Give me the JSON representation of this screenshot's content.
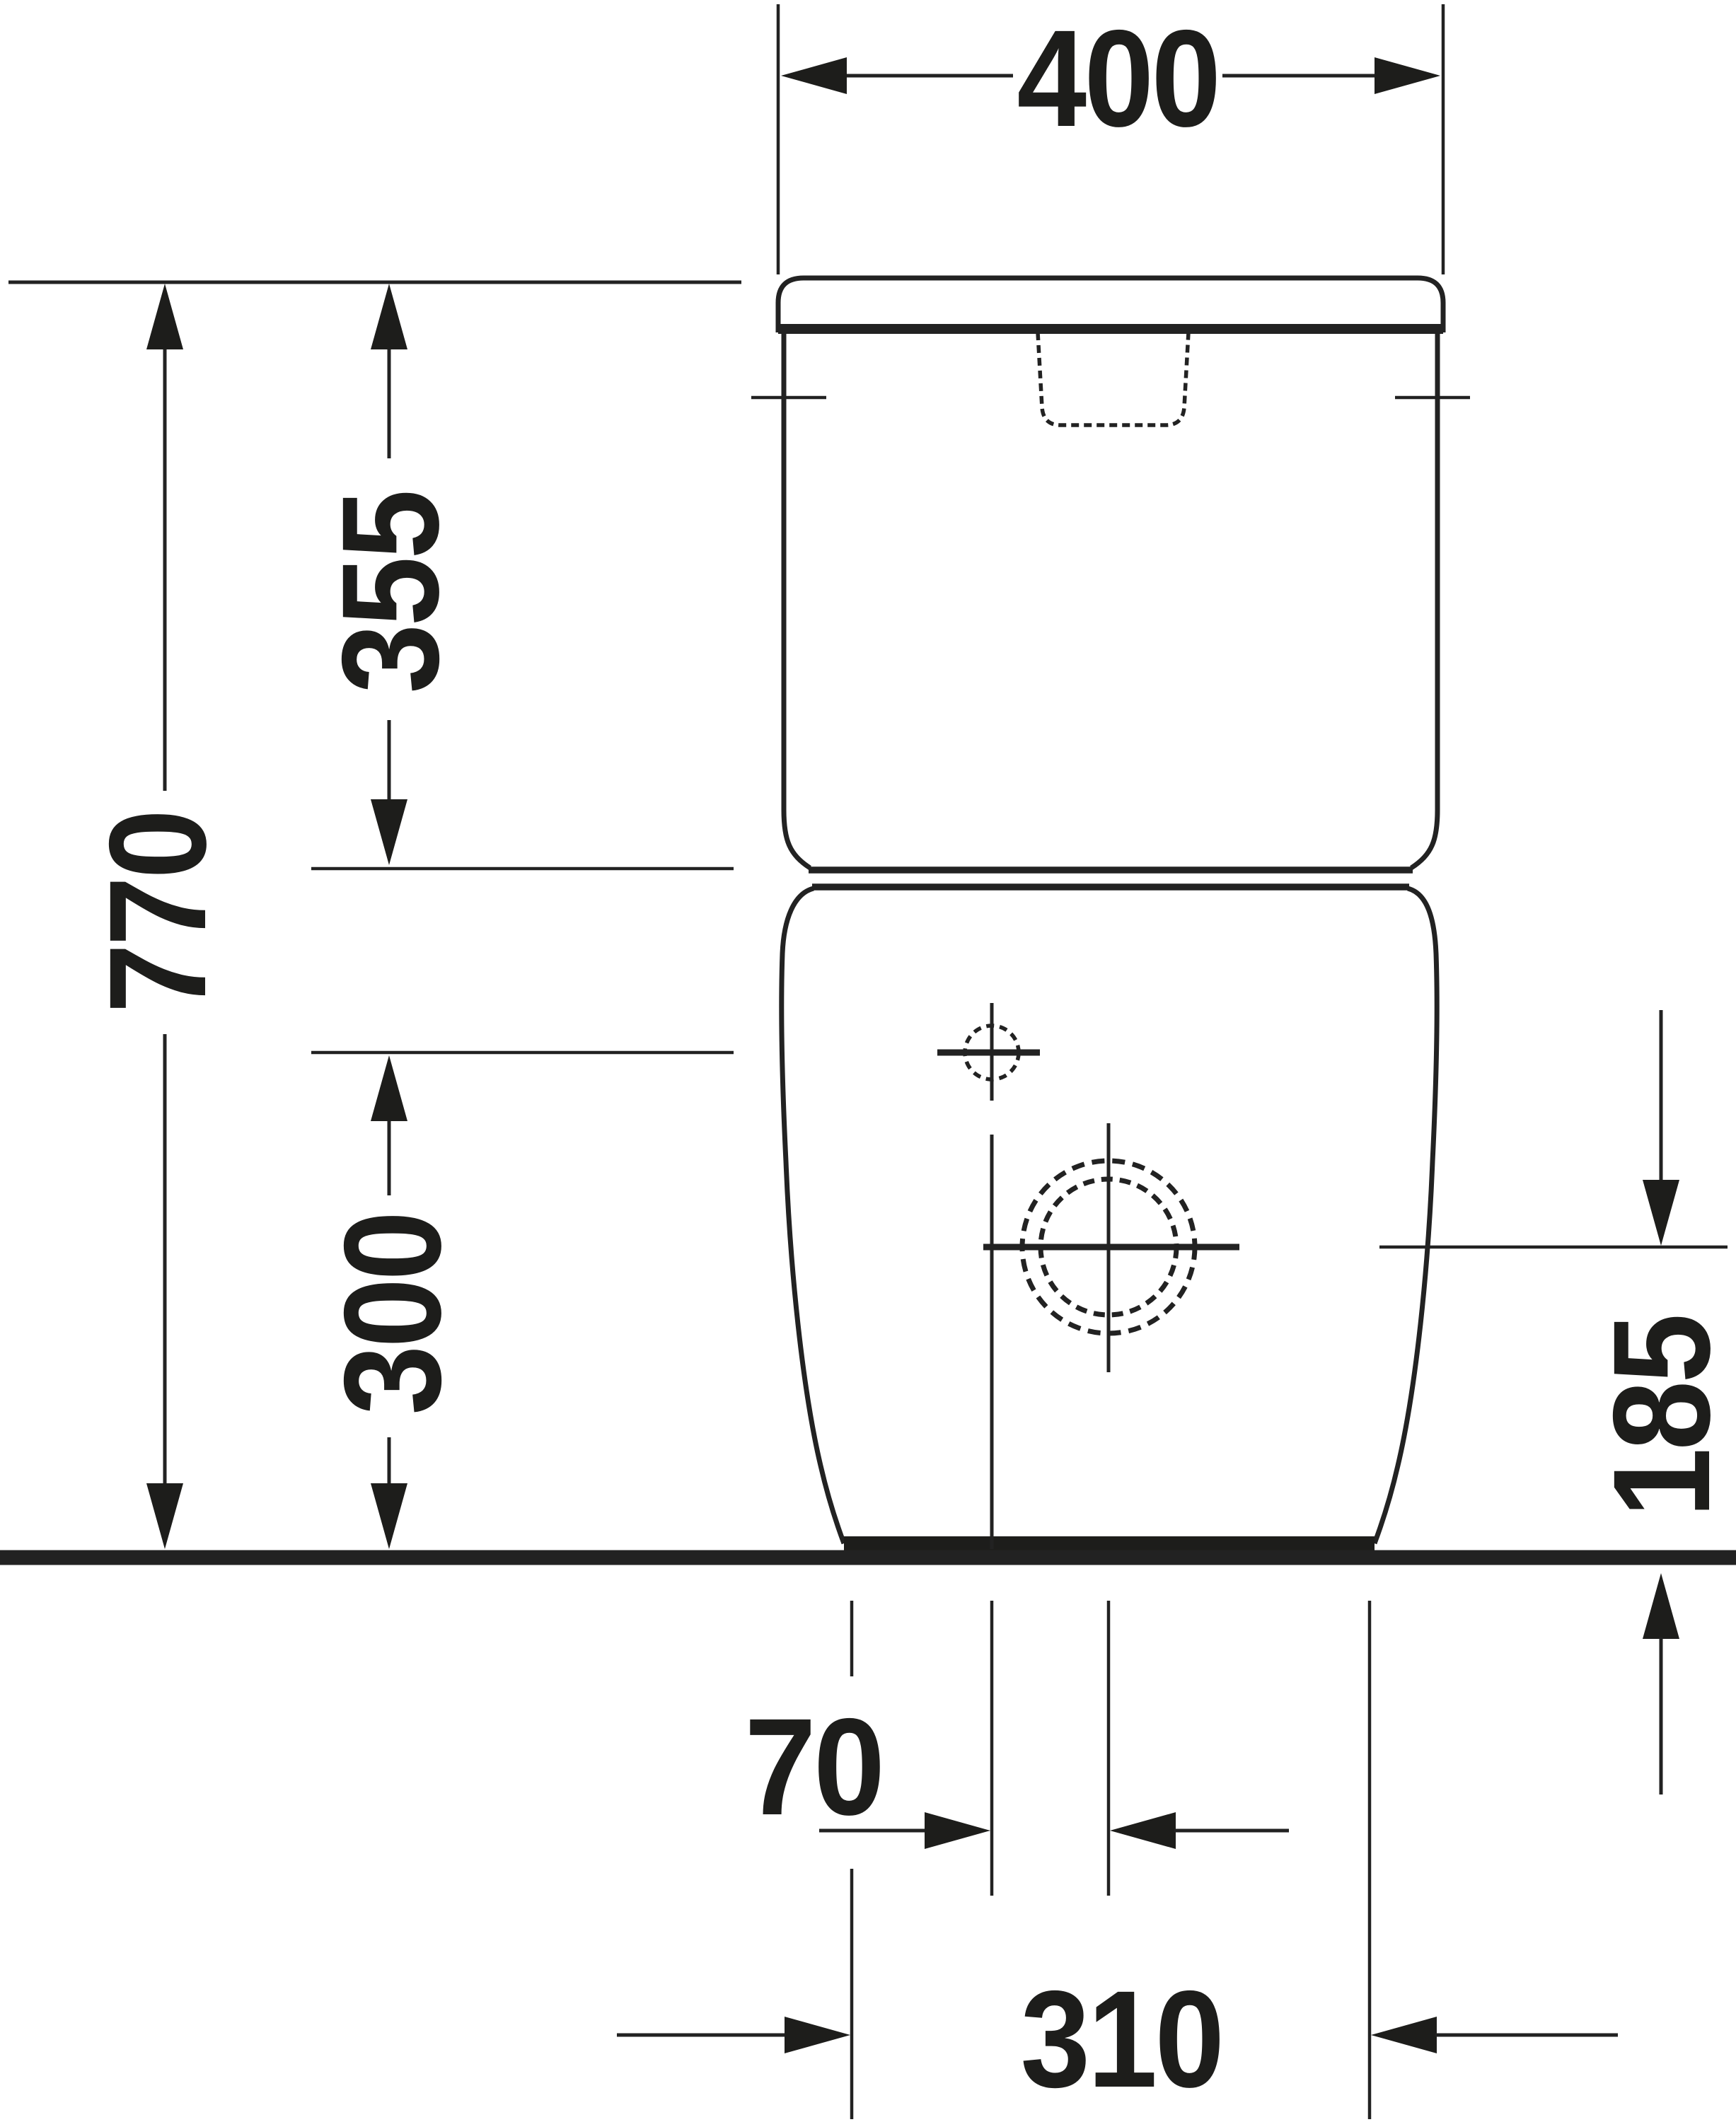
{
  "drawing": {
    "title": "Technical dimension drawing - close-coupled floor-standing WC, rear elevation",
    "units": "mm",
    "line_color": "#1d1d1b",
    "background_color": "#ffffff",
    "dimensions": {
      "cistern_width": {
        "label": "400",
        "meaning": "overall width of cistern"
      },
      "cistern_height": {
        "label": "355",
        "meaning": "cistern height from lid top"
      },
      "overall_height": {
        "label": "770",
        "meaning": "overall height above floor"
      },
      "supply_height": {
        "label": "300",
        "meaning": "water supply connection height above floor"
      },
      "outlet_height": {
        "label": "185",
        "meaning": "outlet centre height above floor"
      },
      "supply_offset": {
        "label": "70",
        "meaning": "supply connection offset from centre"
      },
      "base_width": {
        "label": "310",
        "meaning": "base width at floor"
      }
    }
  }
}
